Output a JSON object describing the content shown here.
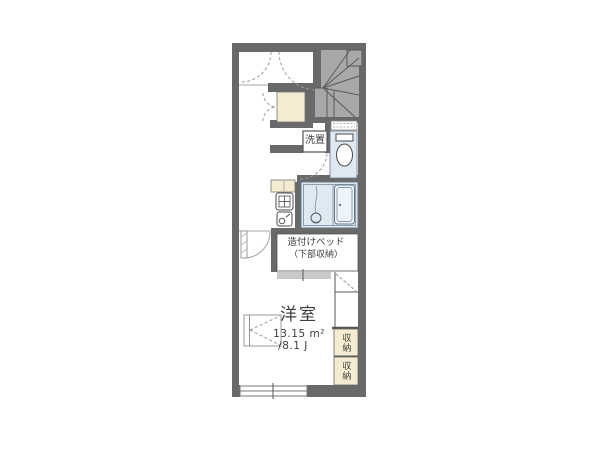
{
  "floorplan": {
    "rooms": {
      "main_room": {
        "name": "洋室",
        "area_sqm": "13.15 m²",
        "area_tatami": "/8.1 J"
      },
      "built_in_bed": {
        "line1": "造付けベッド",
        "line2": "（下部収納）"
      },
      "laundry_space": {
        "label": "洗置"
      },
      "storage_top": {
        "label": "収納"
      },
      "storage_bottom": {
        "label": "収納"
      }
    },
    "fixtures": [
      "staircase",
      "toilet",
      "bathtub",
      "shower-drain",
      "kitchen-sink",
      "gas-stove",
      "washing-machine-space",
      "built-in-bed",
      "storage-closet-top",
      "storage-closet-bottom",
      "entrance-door-swings",
      "closet-double-doors",
      "bedroom-door",
      "casement-window-left",
      "sliding-window-bottom",
      "small-window-above-toilet"
    ],
    "colors": {
      "wall": "#696969",
      "stair_fill": "#a8a8a8",
      "wet_area": "#dfe9f1",
      "cream": "#f4ebd0",
      "bed_edge": "#c9c9c9",
      "background": "#ffffff",
      "text": "#3e3e3e"
    }
  }
}
